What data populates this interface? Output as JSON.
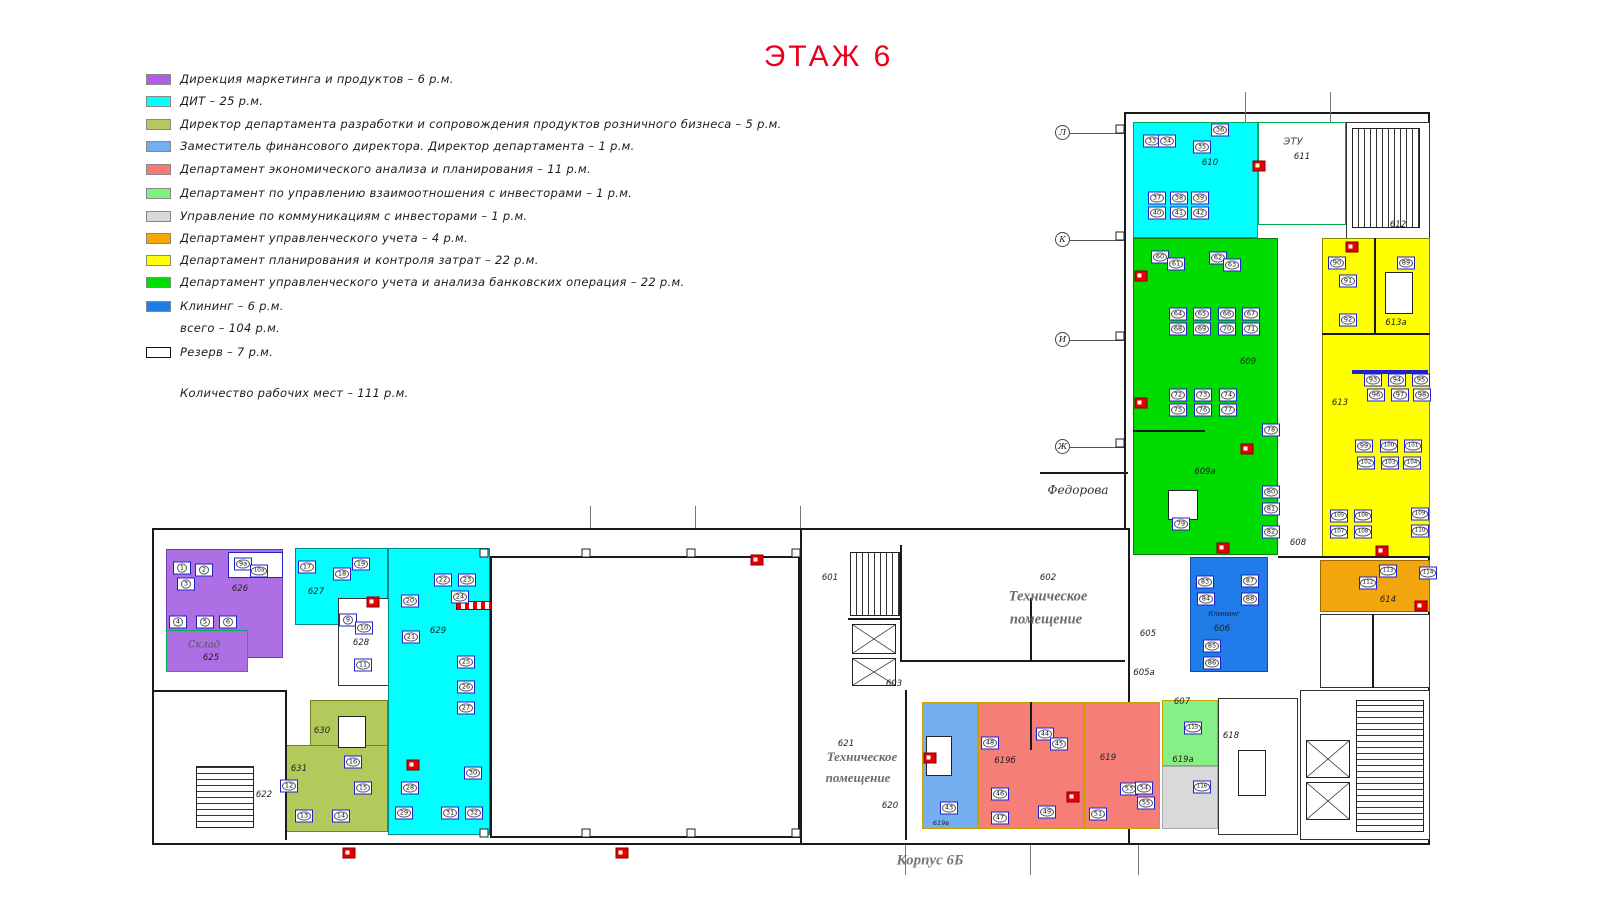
{
  "title": "ЭТАЖ 6",
  "title_color": "#e8001c",
  "legend": {
    "items": [
      {
        "color": "#b45ce8",
        "label": "Дирекция маркетинга и продуктов  – 6 р.м.",
        "y": 0
      },
      {
        "color": "#00ffff",
        "label": "ДИТ – 25 р.м.",
        "y": 22
      },
      {
        "color": "#b5c95a",
        "label": "Директор департамента разработки и сопровождения продуктов розничного бизнеса –  5 р.м.",
        "y": 45
      },
      {
        "color": "#74aef0",
        "label": "Заместитель финансового директора. Директор департамента  – 1 р.м.",
        "y": 67
      },
      {
        "color": "#f87a75",
        "label": "Департамент экономического анализа и планирования – 11 р.м.",
        "y": 90
      },
      {
        "color": "#7df27d",
        "label": "Департамент по управлению взаимоотношения с инвесторами – 1 р.м.",
        "y": 114
      },
      {
        "color": "#d9d9d9",
        "label": "Управление по коммуникациям с инвесторами – 1 р.м.",
        "y": 137
      },
      {
        "color": "#f5a800",
        "label": "Департамент управленческого учета – 4 р.м.",
        "y": 159
      },
      {
        "color": "#ffff00",
        "label": "Департамент планирования и контроля затрат – 22 р.м.",
        "y": 181
      },
      {
        "color": "#00dd00",
        "label": "Департамент управленческого учета и анализа банковских операция – 22 р.м.",
        "y": 203
      },
      {
        "color": "#1f7ce8",
        "label": "Клининг – 6 р.м.",
        "y": 227
      }
    ],
    "total_line": {
      "label": "всего  – 104 р.м.",
      "y": 249
    },
    "reserve": {
      "label": "Резерв – 7 р.м.",
      "y": 273
    },
    "workplaces_line": {
      "label": "Количество рабочих мест – 111 р.м.",
      "y": 314
    }
  },
  "plan": {
    "walls": [
      {
        "x": 1124,
        "y": 112,
        "w": 306,
        "h": 733
      },
      {
        "x": 152,
        "y": 528,
        "w": 978,
        "h": 317
      },
      {
        "x": 490,
        "y": 556,
        "w": 310,
        "h": 282
      }
    ],
    "rooms": [
      {
        "id": "610",
        "c": "#00ffff",
        "bd": "#00a651",
        "x": 1133,
        "y": 122,
        "w": 125,
        "h": 116
      },
      {
        "id": "611",
        "c": "#ffffff",
        "bd": "#00a651",
        "x": 1258,
        "y": 122,
        "w": 88,
        "h": 103
      },
      {
        "id": "612",
        "c": "#ffffff",
        "bd": "#333333",
        "x": 1346,
        "y": 122,
        "w": 84,
        "h": 118
      },
      {
        "id": "609",
        "c": "#00dc00",
        "bd": "#0a7a0a",
        "x": 1133,
        "y": 238,
        "w": 145,
        "h": 317
      },
      {
        "id": "613",
        "c": "#ffff00",
        "bd": "#8a8a00",
        "x": 1322,
        "y": 238,
        "w": 108,
        "h": 320
      },
      {
        "id": "606",
        "c": "#1f7ce8",
        "bd": "#0a4fa8",
        "x": 1190,
        "y": 557,
        "w": 78,
        "h": 115
      },
      {
        "id": "614",
        "c": "#f2a50c",
        "bd": "#a06800",
        "x": 1320,
        "y": 560,
        "w": 110,
        "h": 52
      },
      {
        "id": "wc",
        "c": "#ffffff",
        "bd": "#333333",
        "x": 1320,
        "y": 614,
        "w": 110,
        "h": 74
      },
      {
        "id": "618",
        "c": "#ffffff",
        "bd": "#333333",
        "x": 1218,
        "y": 698,
        "w": 80,
        "h": 137
      },
      {
        "id": "elevators",
        "c": "#ffffff",
        "bd": "#333333",
        "x": 1300,
        "y": 690,
        "w": 130,
        "h": 150
      },
      {
        "id": "626",
        "c": "#af6fe4",
        "bd": "#6a3ab0",
        "x": 166,
        "y": 549,
        "w": 117,
        "h": 109
      },
      {
        "id": "626w",
        "c": "#ffffff",
        "bd": "#2121cc",
        "x": 228,
        "y": 552,
        "w": 55,
        "h": 26
      },
      {
        "id": "625",
        "c": "#af6fe4",
        "bd": "#00b050",
        "x": 166,
        "y": 630,
        "w": 82,
        "h": 42
      },
      {
        "id": "627",
        "c": "#00ffff",
        "bd": "#008a8a",
        "x": 295,
        "y": 548,
        "w": 93,
        "h": 77
      },
      {
        "id": "628",
        "c": "#ffffff",
        "bd": "#333333",
        "x": 338,
        "y": 598,
        "w": 52,
        "h": 88
      },
      {
        "id": "629",
        "c": "#00ffff",
        "bd": "#008a8a",
        "x": 388,
        "y": 548,
        "w": 102,
        "h": 287
      },
      {
        "id": "630",
        "c": "#b3c95b",
        "bd": "#6e8020",
        "x": 310,
        "y": 700,
        "w": 78,
        "h": 58
      },
      {
        "id": "631",
        "c": "#b3c95b",
        "bd": "#6e8020",
        "x": 285,
        "y": 745,
        "w": 103,
        "h": 87
      },
      {
        "id": "619v",
        "c": "#74aef0",
        "bd": "#c8a000",
        "x": 922,
        "y": 702,
        "w": 56,
        "h": 127
      },
      {
        "id": "619b",
        "c": "#f57e79",
        "bd": "#c8a000",
        "x": 978,
        "y": 702,
        "w": 106,
        "h": 127
      },
      {
        "id": "619",
        "c": "#f57e79",
        "bd": "#c8a000",
        "x": 1084,
        "y": 702,
        "w": 76,
        "h": 127
      },
      {
        "id": "619a",
        "c": "#86ef86",
        "bd": "#c8a000",
        "x": 1162,
        "y": 700,
        "w": 56,
        "h": 66
      },
      {
        "id": "619gray",
        "c": "#d9d9d9",
        "bd": "#aaaaaa",
        "x": 1162,
        "y": 766,
        "w": 56,
        "h": 63
      }
    ],
    "lines": [
      [
        1322,
        333,
        1430,
        333
      ],
      [
        1374,
        238,
        1374,
        333
      ],
      [
        1133,
        430,
        1205,
        430
      ],
      [
        1030,
        702,
        1030,
        750
      ],
      [
        900,
        545,
        900,
        660
      ],
      [
        1030,
        598,
        1030,
        660
      ],
      [
        900,
        660,
        1125,
        660
      ],
      [
        848,
        618,
        900,
        618
      ],
      [
        800,
        528,
        800,
        845
      ],
      [
        905,
        690,
        905,
        840
      ],
      [
        1278,
        556,
        1430,
        556
      ],
      [
        1372,
        614,
        1372,
        688
      ],
      [
        152,
        690,
        285,
        690
      ],
      [
        285,
        690,
        285,
        840
      ],
      [
        1040,
        472,
        1128,
        472
      ]
    ],
    "stubs": [
      [
        1245,
        92,
        1245,
        122
      ],
      [
        1330,
        92,
        1330,
        122
      ],
      [
        590,
        506,
        590,
        528
      ],
      [
        695,
        506,
        695,
        528
      ],
      [
        800,
        506,
        800,
        528
      ],
      [
        905,
        845,
        905,
        875
      ],
      [
        1030,
        845,
        1030,
        875
      ],
      [
        1138,
        845,
        1138,
        875
      ]
    ],
    "hatches": [
      {
        "x": 1352,
        "y": 128,
        "w": 68,
        "h": 100,
        "dir": "v"
      },
      {
        "x": 850,
        "y": 552,
        "w": 50,
        "h": 64,
        "dir": "v"
      },
      {
        "x": 196,
        "y": 766,
        "w": 58,
        "h": 62,
        "dir": "h"
      },
      {
        "x": 1356,
        "y": 700,
        "w": 68,
        "h": 132,
        "dir": "h"
      }
    ],
    "xboxes": [
      {
        "x": 852,
        "y": 624,
        "w": 44,
        "h": 30
      },
      {
        "x": 852,
        "y": 658,
        "w": 44,
        "h": 28
      },
      {
        "x": 1306,
        "y": 740,
        "w": 44,
        "h": 38
      },
      {
        "x": 1306,
        "y": 782,
        "w": 44,
        "h": 38
      }
    ],
    "tables": [
      {
        "x": 1385,
        "y": 272,
        "w": 28,
        "h": 42
      },
      {
        "x": 338,
        "y": 716,
        "w": 28,
        "h": 32
      },
      {
        "x": 1238,
        "y": 750,
        "w": 28,
        "h": 46
      },
      {
        "x": 926,
        "y": 736,
        "w": 26,
        "h": 40
      },
      {
        "x": 1168,
        "y": 490,
        "w": 30,
        "h": 30
      }
    ],
    "strips": [
      {
        "type": "candy",
        "x": 456,
        "y": 601,
        "w": 34,
        "h": 7
      },
      {
        "type": "blue",
        "x": 1352,
        "y": 370,
        "w": 76,
        "h": 4
      }
    ],
    "grid_rows": [
      {
        "letter": "Л",
        "y": 133
      },
      {
        "letter": "К",
        "y": 240
      },
      {
        "letter": "И",
        "y": 340
      },
      {
        "letter": "Ж",
        "y": 447
      }
    ],
    "nodes": [
      [
        1124,
        133
      ],
      [
        1124,
        240
      ],
      [
        1124,
        340
      ],
      [
        1124,
        447
      ],
      [
        488,
        557
      ],
      [
        590,
        557
      ],
      [
        695,
        557
      ],
      [
        800,
        557
      ],
      [
        488,
        837
      ],
      [
        590,
        837
      ],
      [
        695,
        837
      ],
      [
        800,
        837
      ]
    ],
    "labels": [
      [
        "610",
        1210,
        163,
        ""
      ],
      [
        "ЭТУ",
        1293,
        142,
        "s10"
      ],
      [
        "611",
        1302,
        157,
        ""
      ],
      [
        "612",
        1398,
        225,
        ""
      ],
      [
        "609",
        1248,
        362,
        ""
      ],
      [
        "609а",
        1205,
        472,
        ""
      ],
      [
        "613а",
        1396,
        323,
        ""
      ],
      [
        "613",
        1340,
        403,
        ""
      ],
      [
        "614",
        1388,
        600,
        ""
      ],
      [
        "Клининг",
        1224,
        614,
        "cl"
      ],
      [
        "606",
        1222,
        629,
        ""
      ],
      [
        "608",
        1298,
        543,
        ""
      ],
      [
        "607",
        1182,
        702,
        ""
      ],
      [
        "605",
        1148,
        634,
        ""
      ],
      [
        "605а",
        1144,
        673,
        ""
      ],
      [
        "603",
        894,
        684,
        ""
      ],
      [
        "601",
        830,
        578,
        ""
      ],
      [
        "602",
        1048,
        578,
        ""
      ],
      [
        "621",
        846,
        744,
        ""
      ],
      [
        "620",
        890,
        806,
        ""
      ],
      [
        "619в",
        941,
        823,
        "t6"
      ],
      [
        "619б",
        1005,
        761,
        ""
      ],
      [
        "619",
        1108,
        758,
        ""
      ],
      [
        "619а",
        1183,
        760,
        ""
      ],
      [
        "618",
        1231,
        736,
        ""
      ],
      [
        "626",
        240,
        589,
        ""
      ],
      [
        "Склад",
        204,
        645,
        "serif"
      ],
      [
        "625",
        211,
        658,
        ""
      ],
      [
        "627",
        316,
        592,
        ""
      ],
      [
        "628",
        361,
        643,
        ""
      ],
      [
        "629",
        438,
        631,
        ""
      ],
      [
        "630",
        322,
        731,
        ""
      ],
      [
        "631",
        299,
        769,
        ""
      ],
      [
        "622",
        264,
        795,
        ""
      ],
      [
        "Федорова",
        1078,
        490,
        "street"
      ],
      [
        "Техническое",
        1048,
        597,
        "tech"
      ],
      [
        "помещение",
        1046,
        620,
        "tech"
      ],
      [
        "Техническое",
        862,
        757,
        "tech2"
      ],
      [
        "помещение",
        858,
        778,
        "tech2"
      ],
      [
        "Корпус 6Б",
        930,
        861,
        "korp"
      ]
    ],
    "desks": [
      [
        "1",
        182,
        568
      ],
      [
        "2",
        204,
        570
      ],
      [
        "3",
        186,
        584
      ],
      [
        "4",
        178,
        622
      ],
      [
        "5",
        205,
        622
      ],
      [
        "6",
        228,
        622
      ],
      [
        "9а",
        243,
        564
      ],
      [
        "10а",
        259,
        571
      ],
      [
        "9",
        348,
        620
      ],
      [
        "10",
        364,
        628
      ],
      [
        "11",
        363,
        665
      ],
      [
        "17",
        307,
        567
      ],
      [
        "18",
        342,
        574
      ],
      [
        "19",
        361,
        564
      ],
      [
        "20",
        410,
        601
      ],
      [
        "21",
        411,
        637
      ],
      [
        "22",
        443,
        580
      ],
      [
        "23",
        467,
        580
      ],
      [
        "24",
        460,
        597
      ],
      [
        "25",
        466,
        662
      ],
      [
        "26",
        466,
        687
      ],
      [
        "27",
        466,
        708
      ],
      [
        "28",
        410,
        788
      ],
      [
        "29",
        404,
        813
      ],
      [
        "30",
        473,
        773
      ],
      [
        "31",
        450,
        813
      ],
      [
        "32",
        474,
        813
      ],
      [
        "12",
        289,
        786
      ],
      [
        "13",
        304,
        816
      ],
      [
        "14",
        341,
        816
      ],
      [
        "15",
        363,
        788
      ],
      [
        "16",
        353,
        762
      ],
      [
        "33",
        1152,
        141
      ],
      [
        "34",
        1167,
        141
      ],
      [
        "35",
        1202,
        147
      ],
      [
        "36",
        1220,
        130
      ],
      [
        "37",
        1157,
        198
      ],
      [
        "38",
        1179,
        198
      ],
      [
        "39",
        1200,
        198
      ],
      [
        "40",
        1157,
        213
      ],
      [
        "41",
        1179,
        213
      ],
      [
        "42",
        1200,
        213
      ],
      [
        "60",
        1160,
        257
      ],
      [
        "61",
        1176,
        264
      ],
      [
        "62",
        1218,
        258
      ],
      [
        "63",
        1232,
        265
      ],
      [
        "64",
        1178,
        314
      ],
      [
        "65",
        1202,
        314
      ],
      [
        "66",
        1227,
        314
      ],
      [
        "67",
        1251,
        314
      ],
      [
        "68",
        1178,
        329
      ],
      [
        "69",
        1202,
        329
      ],
      [
        "70",
        1227,
        329
      ],
      [
        "71",
        1251,
        329
      ],
      [
        "72",
        1178,
        395
      ],
      [
        "73",
        1203,
        395
      ],
      [
        "74",
        1228,
        395
      ],
      [
        "75",
        1178,
        410
      ],
      [
        "76",
        1203,
        410
      ],
      [
        "77",
        1228,
        410
      ],
      [
        "78",
        1271,
        430
      ],
      [
        "79",
        1181,
        524
      ],
      [
        "80",
        1271,
        492
      ],
      [
        "81",
        1271,
        509
      ],
      [
        "82",
        1271,
        532
      ],
      [
        "89",
        1406,
        263
      ],
      [
        "90",
        1337,
        263
      ],
      [
        "91",
        1348,
        281
      ],
      [
        "92",
        1348,
        320
      ],
      [
        "93",
        1373,
        380
      ],
      [
        "94",
        1397,
        380
      ],
      [
        "95",
        1421,
        380
      ],
      [
        "96",
        1376,
        395
      ],
      [
        "97",
        1400,
        395
      ],
      [
        "98",
        1422,
        395
      ],
      [
        "99",
        1364,
        446
      ],
      [
        "100",
        1389,
        446
      ],
      [
        "101",
        1413,
        446
      ],
      [
        "102",
        1366,
        463
      ],
      [
        "103",
        1390,
        463
      ],
      [
        "104",
        1412,
        463
      ],
      [
        "105",
        1339,
        516
      ],
      [
        "106",
        1363,
        516
      ],
      [
        "107",
        1339,
        532
      ],
      [
        "108",
        1363,
        532
      ],
      [
        "109",
        1420,
        514
      ],
      [
        "110",
        1420,
        531
      ],
      [
        "83",
        1205,
        582
      ],
      [
        "84",
        1206,
        599
      ],
      [
        "85",
        1212,
        646
      ],
      [
        "86",
        1212,
        663
      ],
      [
        "87",
        1250,
        581
      ],
      [
        "88",
        1250,
        599
      ],
      [
        "112",
        1368,
        583
      ],
      [
        "113",
        1388,
        571
      ],
      [
        "114",
        1428,
        573
      ],
      [
        "43",
        949,
        808
      ],
      [
        "44",
        1045,
        734
      ],
      [
        "45",
        1059,
        744
      ],
      [
        "46",
        1000,
        794
      ],
      [
        "47",
        1000,
        818
      ],
      [
        "48",
        990,
        743
      ],
      [
        "49",
        1047,
        812
      ],
      [
        "51",
        1098,
        814
      ],
      [
        "53",
        1129,
        789
      ],
      [
        "54",
        1144,
        788
      ],
      [
        "55",
        1146,
        803
      ],
      [
        "115",
        1193,
        728
      ],
      [
        "116",
        1202,
        787
      ]
    ],
    "extinguishers": [
      [
        1259,
        166
      ],
      [
        1141,
        276
      ],
      [
        1141,
        403
      ],
      [
        1247,
        449
      ],
      [
        1223,
        548
      ],
      [
        1352,
        247
      ],
      [
        1382,
        551
      ],
      [
        1421,
        606
      ],
      [
        930,
        758
      ],
      [
        1073,
        797
      ],
      [
        373,
        602
      ],
      [
        413,
        765
      ],
      [
        757,
        560
      ],
      [
        349,
        853
      ],
      [
        622,
        853
      ]
    ]
  }
}
